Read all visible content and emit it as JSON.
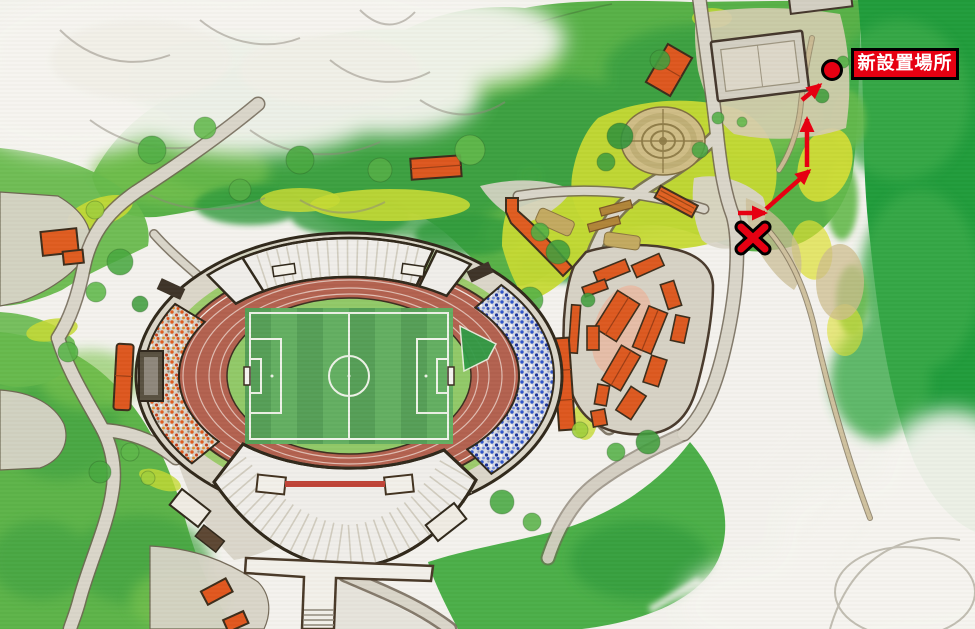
{
  "annotation": {
    "label": "新設置場所",
    "accent_red": "#e60012",
    "label_text_color": "#ffffff",
    "label_border_color": "#000000",
    "marker_icon": "red-circle-marker",
    "x_icon": "red-x-marker",
    "route_icon": "red-route-arrows"
  },
  "map": {
    "style": "hand-drawn watercolor illustrated park map",
    "features": [
      "athletics-stadium",
      "running-track",
      "soccer-field",
      "grandstand-roofs",
      "west-stand-orange-seats",
      "east-stand-blue-seats",
      "facility-building-cluster",
      "circular-garden-maze",
      "tennis-courts",
      "footbridge",
      "forest",
      "lawns",
      "roads-and-paths",
      "unpainted-paper-clouds"
    ],
    "palette": {
      "track": "#b2604e",
      "field_green": "#579f55",
      "forest_dark": "#1f9b3a",
      "forest_mid": "#56b046",
      "lawn_yellow_green": "#c5d932",
      "road_gray": "#d8d4c7",
      "roof_white": "#efeeea",
      "building_orange": "#dc571e",
      "east_seats_blue": "#2e54c9",
      "west_seats_orange": "#e05a1d"
    }
  }
}
